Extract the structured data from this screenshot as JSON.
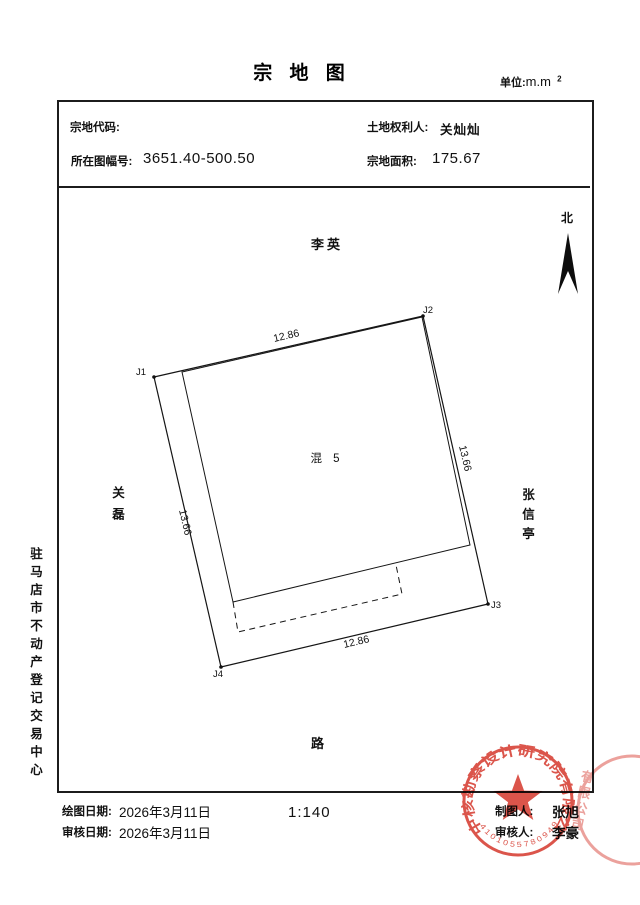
{
  "document": {
    "title": "宗 地 图",
    "unit_label": "单位:",
    "unit_value": "m.m",
    "unit_sup": "2"
  },
  "header": {
    "parcel_code_label": "宗地代码:",
    "parcel_code_value": "",
    "map_sheet_label": "所在图幅号:",
    "map_sheet_value": "3651.40-500.50",
    "rights_holder_label": "土地权利人:",
    "rights_holder_value": "关灿灿",
    "area_label": "宗地面积:",
    "area_value": "175.67"
  },
  "compass": {
    "label": "北"
  },
  "neighbors": {
    "top": "李英",
    "left": "关磊",
    "right": "张信亭",
    "bottom": "路"
  },
  "sidebar_org": "驻马店市不动产登记交易中心",
  "parcel": {
    "vertex_labels": [
      "J1",
      "J2",
      "J3",
      "J4"
    ],
    "dim_top": "12.86",
    "dim_right": "13.66",
    "dim_bottom": "12.86",
    "dim_left": "13.66",
    "building_label": "混 5"
  },
  "footer": {
    "draw_date_label": "绘图日期:",
    "draw_date": "2026年3月11日",
    "review_date_label": "审核日期:",
    "review_date": "2026年3月11日",
    "scale": "1:140",
    "drafter_label": "制图人:",
    "drafter": "张旭",
    "reviewer_label": "审核人:",
    "reviewer": "李豪"
  },
  "seal": {
    "company": "中核勘察设计研究院有限公司",
    "serial": "4101055780949",
    "ghost": "有限公司",
    "color": "#d8463b"
  }
}
